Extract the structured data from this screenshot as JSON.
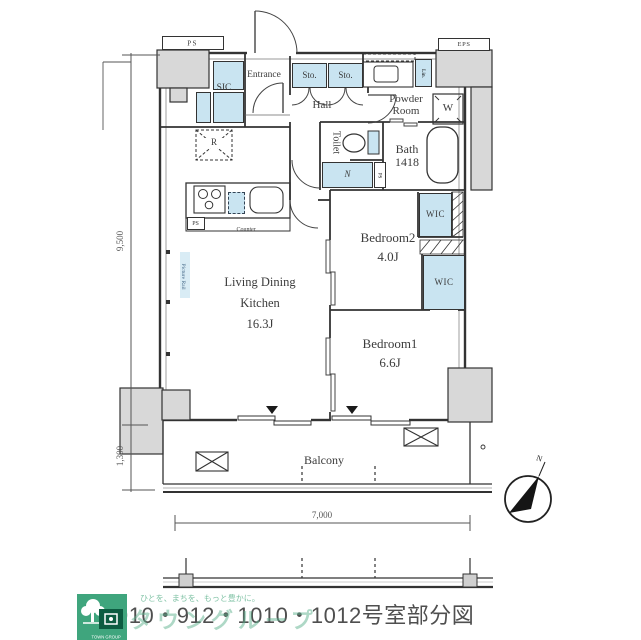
{
  "plan": {
    "labels": {
      "ps_top": "PS",
      "eps": "EPS",
      "sic": "SIC",
      "entrance": "Entrance",
      "sto_left": "Sto.",
      "sto_right": "Sto.",
      "hall": "Hall",
      "powder_line1": "Powder",
      "powder_line2": "Room",
      "linen": "Lin.",
      "washer": "W",
      "toilet": "Toilet",
      "bath_name": "Bath",
      "bath_size": "1418",
      "n_storage": "N",
      "ps_shaft": "PS",
      "fridge": "R",
      "ps_kitchen": "PS",
      "counter": "Counter",
      "picture_rail": "Picture Rail",
      "ldk_line1": "Living Dining",
      "ldk_line2": "Kitchen",
      "ldk_size": "16.3J",
      "bedroom2_name": "Bedroom2",
      "bedroom2_size": "4.0J",
      "wic_upper": "WIC",
      "wic_lower": "WIC",
      "bedroom1_name": "Bedroom1",
      "bedroom1_size": "6.6J",
      "balcony": "Balcony"
    },
    "dimensions": {
      "left_main": "9,500",
      "left_balcony": "1,300",
      "bottom": "7,000"
    },
    "compass": "N"
  },
  "footer": {
    "room_title": "910・912・1010・1012号室部分図",
    "watermark_tagline": "ひとを、まちを、もっと豊かに。",
    "watermark_brand": "タウングループ",
    "logo_text": "TOWN GROUP"
  },
  "colors": {
    "wall": "#3a3a3a",
    "pillar_fill": "#d8d8d8",
    "closet_fill": "#c9e4f1",
    "brand_green": "#3fa57d",
    "watermark_green": "#68b794",
    "title_text": "#4f4f4f"
  }
}
